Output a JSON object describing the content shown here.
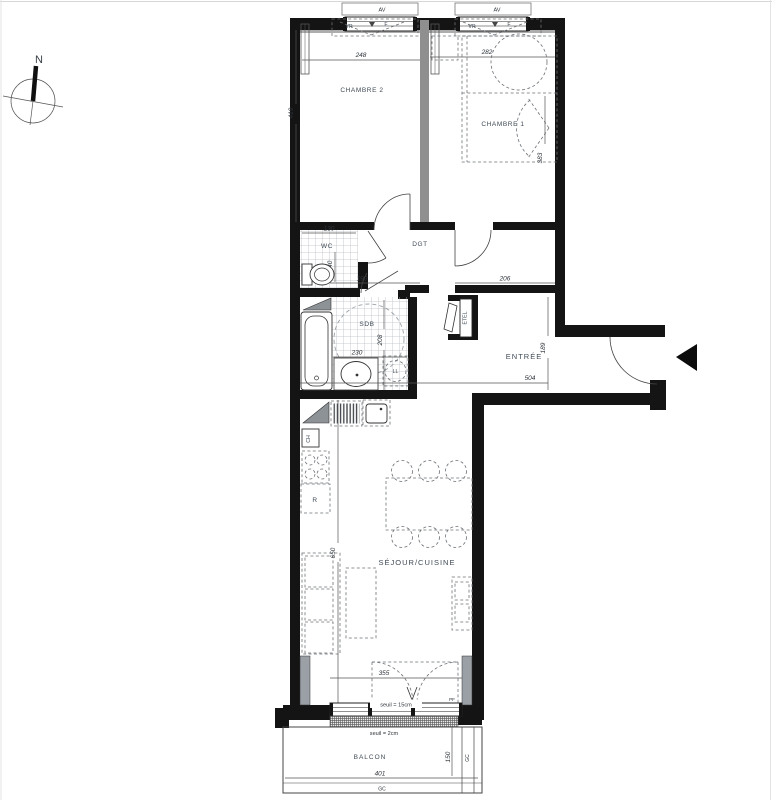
{
  "compass": {
    "north": "N"
  },
  "labels": {
    "chambre2": "CHAMBRE 2",
    "chambre1": "CHAMBRE 1",
    "wc": "WC",
    "dgt": "DGT",
    "sdb": "SDB",
    "entree": "ENTRÉE",
    "sejour_cuisine": "SÉJOUR/CUISINE",
    "balcon": "BALCON",
    "etel": "ETEL",
    "ch": "CH",
    "fridge": "R",
    "washer": "LL"
  },
  "openings": {
    "av_left": "AV",
    "av_right": "AV",
    "vr_left": "VR",
    "f_left": "F",
    "vr_right": "VR",
    "f_right": "F",
    "pf": "PF"
  },
  "dimensions": {
    "chambre2_width": "248",
    "chambre1_width": "282",
    "chambre2_depth": "419",
    "chambre1_depth": "383",
    "wc_width": "130",
    "wc_depth": "140",
    "dgt_width": "190",
    "hall_width": "206",
    "sdb_width": "230",
    "sdb_depth": "208",
    "entree_depth": "189",
    "entree_width": "504",
    "sejour_depth": "650",
    "bay_width": "355",
    "balcon_depth": "150",
    "balcon_width": "401"
  },
  "notes": {
    "seuil_bay": "seuil = 15cm",
    "seuil_balcon": "seuil = 2cm",
    "gc_side": "GC",
    "gc_bottom": "GC"
  },
  "colors": {
    "wall": "#141414",
    "partition": "#8f8f8f",
    "label": "#3f4a55",
    "dim": "#2e343a"
  }
}
